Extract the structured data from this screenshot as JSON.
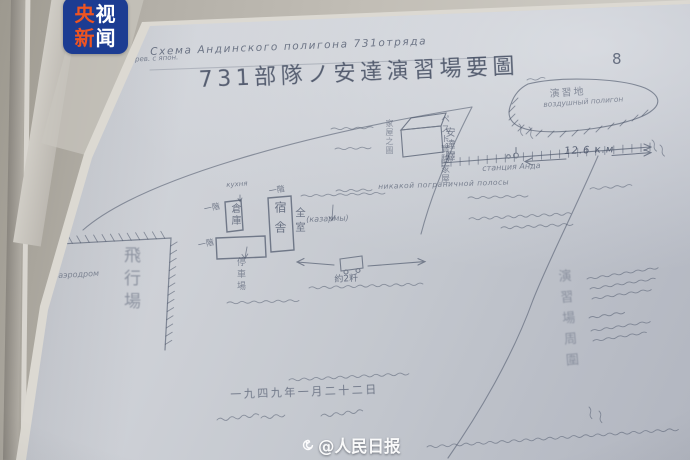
{
  "colors": {
    "logo_background": "#1c3c92",
    "logo_accent_red": "#ee5422",
    "logo_text_white": "#ffffff",
    "pencil_ink": "#465063",
    "photocopy_paper": "#c9ccd3",
    "desk_paper": "#bdb9b1"
  },
  "badge": {
    "line1_char1": "央",
    "line1_char2": "视",
    "line2_char1": "新",
    "line2_char2": "闻"
  },
  "watermark": {
    "icon": "weibo-spiral-icon",
    "text": "@人民日报"
  },
  "document": {
    "page_number": "8",
    "title_ru": "Схема Андинского полигона 731отряда",
    "title_cn": "731部隊ノ安達演習場要圖",
    "margin_note_ru": "перев. с япон.",
    "map_labels": {
      "hill_area_cn": "演習地",
      "hill_area_ru": "воздушный полигон",
      "station_cn": "安達驛",
      "station_ru": "станция Анда",
      "railway_distance": "12.6 к.м",
      "airfield_cn": "飛行場",
      "airfield_ru": "аэродром",
      "dormitory_cn": "宿舎",
      "dormitory_rooms_cn": "全室",
      "storehouse_cn": "倉庫",
      "one_story_label_1": "一階",
      "one_story_label_2": "一階",
      "one_story_label_3": "一階",
      "kitchen_ru": "кухня",
      "barracks_ru": "(казармы)",
      "parking_cn": "停車場",
      "distance_to_site": "約2粁",
      "experiment_house_cn": "ペスト實驗家屋",
      "house_sketch_cn": "家屋之圖",
      "boundary_note_ru": "никакой пограничной полосы",
      "perimeter_cn": "演習場周圍",
      "date_cn": "一九四九年一月二十二日"
    }
  }
}
